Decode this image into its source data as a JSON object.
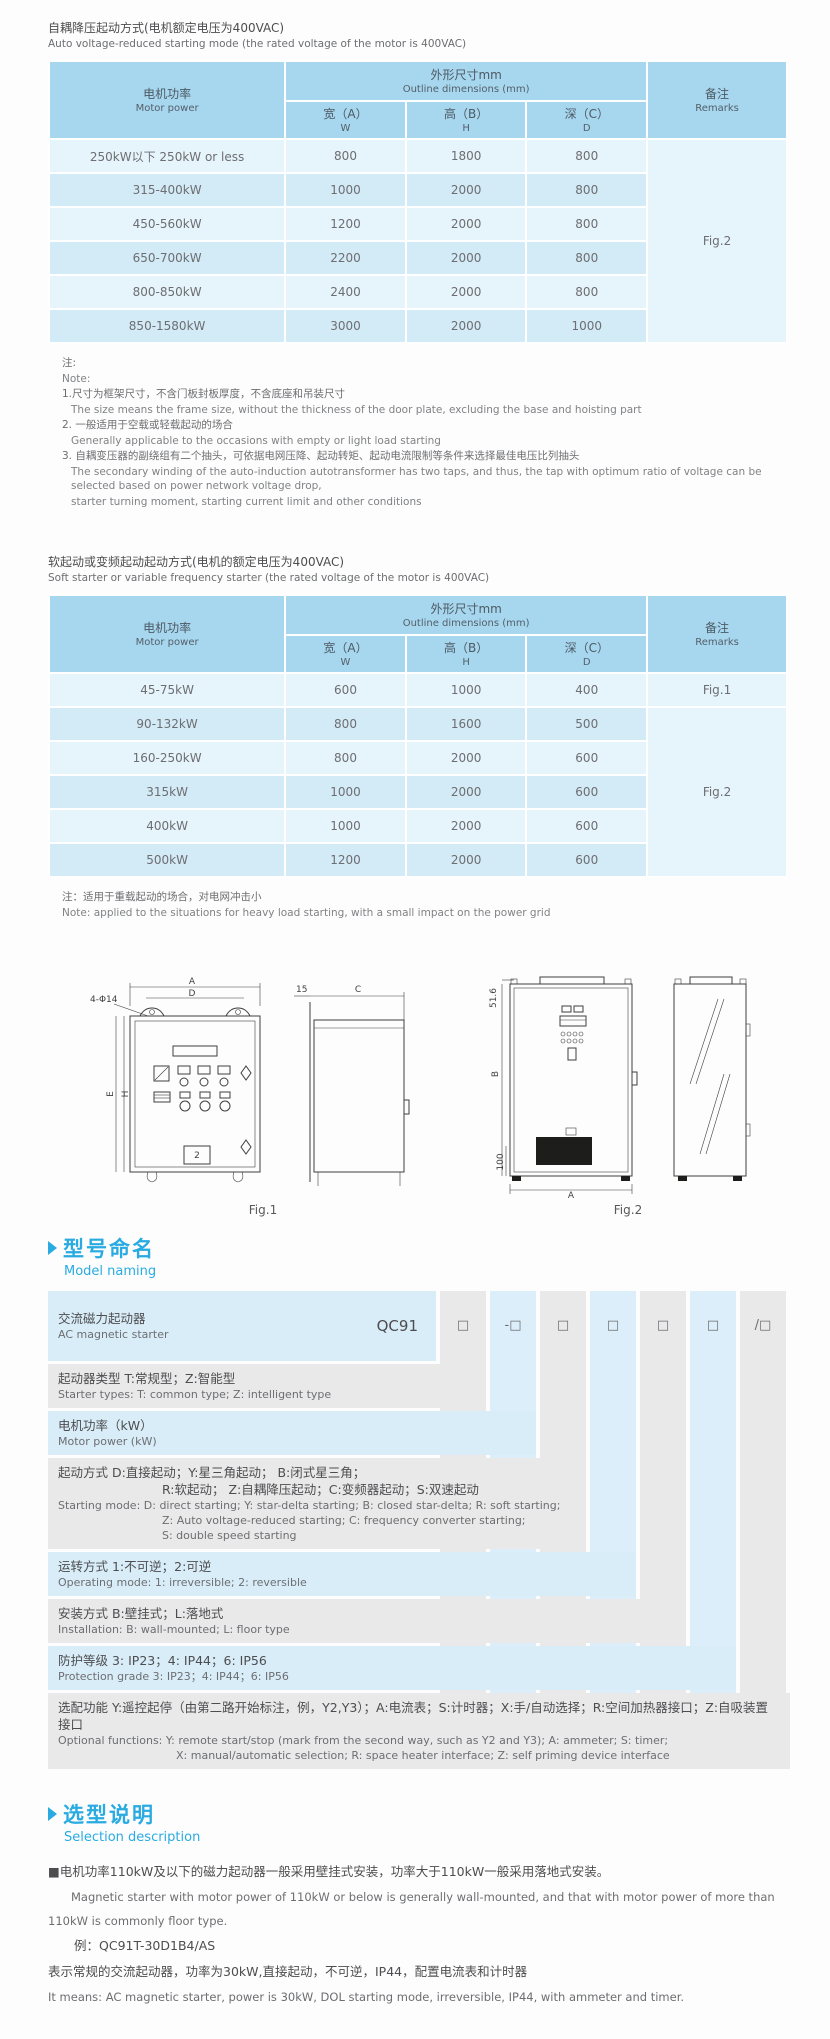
{
  "t1": {
    "title_zh": "自耦降压起动方式(电机额定电压为400VAC)",
    "title_en": "Auto voltage-reduced starting mode (the rated voltage of the motor is 400VAC)",
    "header": {
      "motor_zh": "电机功率",
      "motor_en": "Motor power",
      "outline_zh": "外形尺寸mm",
      "outline_en": "Outline dimensions (mm)",
      "w_zh": "宽（A）",
      "w_en": "W",
      "h_zh": "高（B）",
      "h_en": "H",
      "d_zh": "深（C）",
      "d_en": "D",
      "rem_zh": "备注",
      "rem_en": "Remarks"
    },
    "rows": [
      {
        "power": "250kW以下 250kW or less",
        "w": "800",
        "h": "1800",
        "d": "800"
      },
      {
        "power": "315-400kW",
        "w": "1000",
        "h": "2000",
        "d": "800"
      },
      {
        "power": "450-560kW",
        "w": "1200",
        "h": "2000",
        "d": "800"
      },
      {
        "power": "650-700kW",
        "w": "2200",
        "h": "2000",
        "d": "800"
      },
      {
        "power": "800-850kW",
        "w": "2400",
        "h": "2000",
        "d": "800"
      },
      {
        "power": "850-1580kW",
        "w": "3000",
        "h": "2000",
        "d": "1000"
      }
    ],
    "remark": "Fig.2"
  },
  "notes1": {
    "zh_label": "注:",
    "en_label": "Note:",
    "i1_zh": "1.尺寸为框架尺寸，不含门板封板厚度，不含底座和吊装尺寸",
    "i1_en": "The size means the frame size, without the thickness of the door plate, excluding the base and hoisting part",
    "i2_zh": "2. 一般适用于空载或轻载起动的场合",
    "i2_en": "Generally applicable to the occasions with empty or light load starting",
    "i3_zh": "3. 自耦变压器的副绕组有二个抽头，可依据电网压降、起动转矩、起动电流限制等条件来选择最佳电压比列抽头",
    "i3_en": "The secondary winding of the auto-induction autotransformer has two taps, and thus, the tap with optimum ratio of voltage can be selected based on power network voltage drop,",
    "i3_en2": "starter turning moment, starting current limit and other conditions"
  },
  "t2": {
    "title_zh": "软起动或变频起动起动方式(电机的额定电压为400VAC)",
    "title_en": "Soft starter or variable frequency starter (the rated voltage of the motor is 400VAC)",
    "rows": [
      {
        "power": "45-75kW",
        "w": "600",
        "h": "1000",
        "d": "400"
      },
      {
        "power": "90-132kW",
        "w": "800",
        "h": "1600",
        "d": "500"
      },
      {
        "power": "160-250kW",
        "w": "800",
        "h": "2000",
        "d": "600"
      },
      {
        "power": "315kW",
        "w": "1000",
        "h": "2000",
        "d": "600"
      },
      {
        "power": "400kW",
        "w": "1000",
        "h": "2000",
        "d": "600"
      },
      {
        "power": "500kW",
        "w": "1200",
        "h": "2000",
        "d": "600"
      }
    ],
    "remark_row1": "Fig.1",
    "remark_rest": "Fig.2"
  },
  "note2": {
    "zh": "注：适用于重载起动的场合，对电网冲击小",
    "en": "Note: applied to the situations for heavy load starting, with a small impact on the power grid"
  },
  "figures": {
    "fig1_caption": "Fig.1",
    "fig2_caption": "Fig.2",
    "fig1": {
      "dim_a": "A",
      "dim_d": "D",
      "hole": "4-Φ14",
      "dim_e": "E",
      "dim_h": "H",
      "dim_15": "15",
      "dim_c": "C",
      "plate": "2"
    },
    "fig2": {
      "rough": "51.6",
      "dim_b": "B",
      "dim_100": "100",
      "dim_a": "A"
    }
  },
  "naming": {
    "title_zh": "型号命名",
    "title_en": "Model naming",
    "base_code": "QC91",
    "boxes": [
      "□",
      "-□",
      "□",
      "□",
      "□",
      "□",
      "/□"
    ],
    "r1_zh": "交流磁力起动器",
    "r1_en": "AC magnetic starter",
    "r2_zh": "起动器类型 T:常规型；Z:智能型",
    "r2_en": "Starter types: T: common type; Z: intelligent type",
    "r3_zh": "电机功率（kW）",
    "r3_en": "Motor power (kW)",
    "r4_zh1": "起动方式 D:直接起动；Y:星三角起动；    B:闭式星三角；",
    "r4_zh2": "R:软起动；    Z:自耦降压起动；C:变频器起动；S:双速起动",
    "r4_en1": "Starting mode: D: direct starting; Y: star-delta starting; B: closed star-delta; R: soft starting;",
    "r4_en2": "Z: Auto voltage-reduced starting; C: frequency converter starting;",
    "r4_en3": "S: double speed starting",
    "r5_zh": "运转方式 1:不可逆；2:可逆",
    "r5_en": "Operating mode: 1: irreversible; 2: reversible",
    "r6_zh": "安装方式 B:壁挂式；L:落地式",
    "r6_en": "Installation: B: wall-mounted; L: floor type",
    "r7_zh": "防护等级 3: IP23；4: IP44；6: IP56",
    "r7_en": "Protection grade 3: IP23；4: IP44；6: IP56",
    "r8_zh": "选配功能 Y:遥控起停（由第二路开始标注，例，Y2,Y3）；A:电流表；S:计时器；X:手/自动选择；R:空间加热器接口；Z:自吸装置接口",
    "r8_en1": "Optional functions: Y: remote start/stop (mark from the second way, such as Y2 and Y3); A: ammeter; S: timer;",
    "r8_en2": "X: manual/automatic selection; R: space heater interface; Z: self priming device interface"
  },
  "selection": {
    "title_zh": "选型说明",
    "title_en": "Selection description",
    "p1_zh": "■电机功率110kW及以下的磁力起动器一般采用壁挂式安装，功率大于110kW一般采用落地式安装。",
    "p1_en": "Magnetic starter with motor power of 110kW or below is generally wall-mounted, and that with motor power of more than 110kW is commonly floor type.",
    "example": "例：QC91T-30D1B4/AS",
    "p2_zh": "表示常规的交流起动器，功率为30kW,直接起动，不可逆，IP44，配置电流表和计时器",
    "p2_en": "It means: AC magnetic starter, power is 30kW, DOL starting mode, irreversible, IP44, with ammeter and timer."
  }
}
